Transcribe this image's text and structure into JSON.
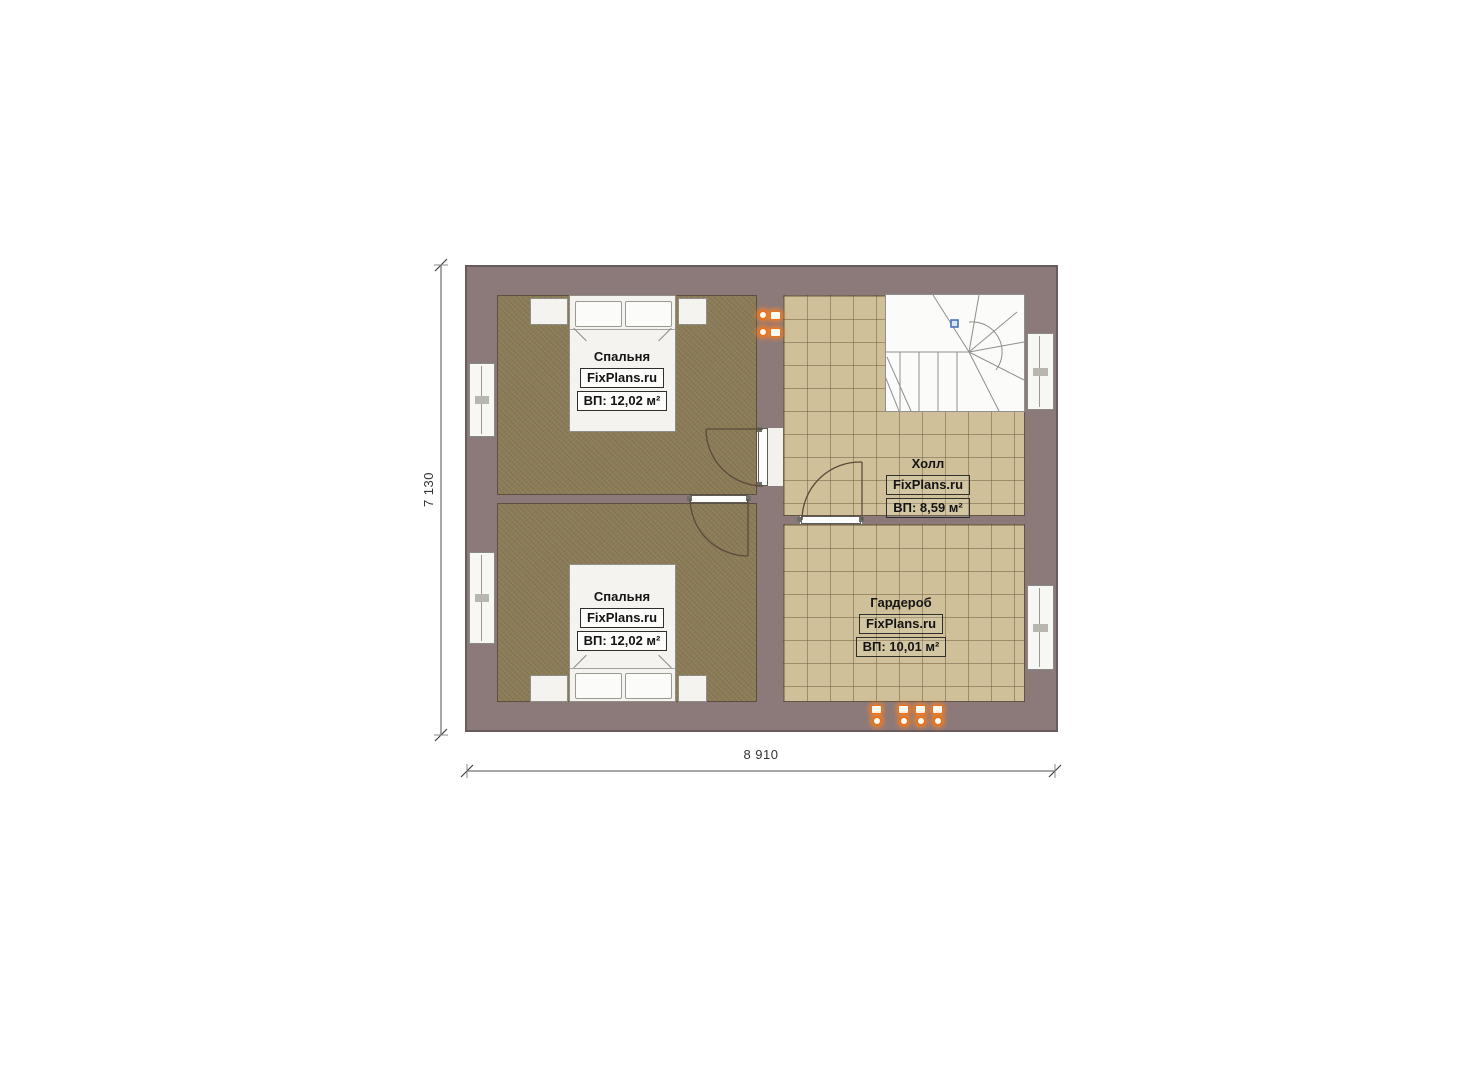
{
  "source": {
    "brand": "FixPlans.ru"
  },
  "plan": {
    "rooms": [
      {
        "key": "bedroom-top",
        "name": "Спальня",
        "brand": "FixPlans.ru",
        "area": "ВП: 12,02 м²"
      },
      {
        "key": "bedroom-bottom",
        "name": "Спальня",
        "brand": "FixPlans.ru",
        "area": "ВП: 12,02 м²"
      },
      {
        "key": "hall",
        "name": "Холл",
        "brand": "FixPlans.ru",
        "area": "ВП: 8,59 м²"
      },
      {
        "key": "wardrobe",
        "name": "Гардероб",
        "brand": "FixPlans.ru",
        "area": "ВП: 10,01 м²"
      }
    ],
    "dimensions": {
      "width": "8 910",
      "height": "7 130"
    },
    "fixtures": {
      "wall_socket_count": 2,
      "bottom_socket_count": 4
    }
  },
  "colors": {
    "wall": "#8c7a7a",
    "bedroom_floor": "#8b7b57",
    "tile_floor": "#cfc099",
    "furniture_white": "#f4f3f0",
    "socket_orange": "#e8731d",
    "stair_marker_blue": "#3f6cb4",
    "dimension_line": "#8a8a8a"
  }
}
